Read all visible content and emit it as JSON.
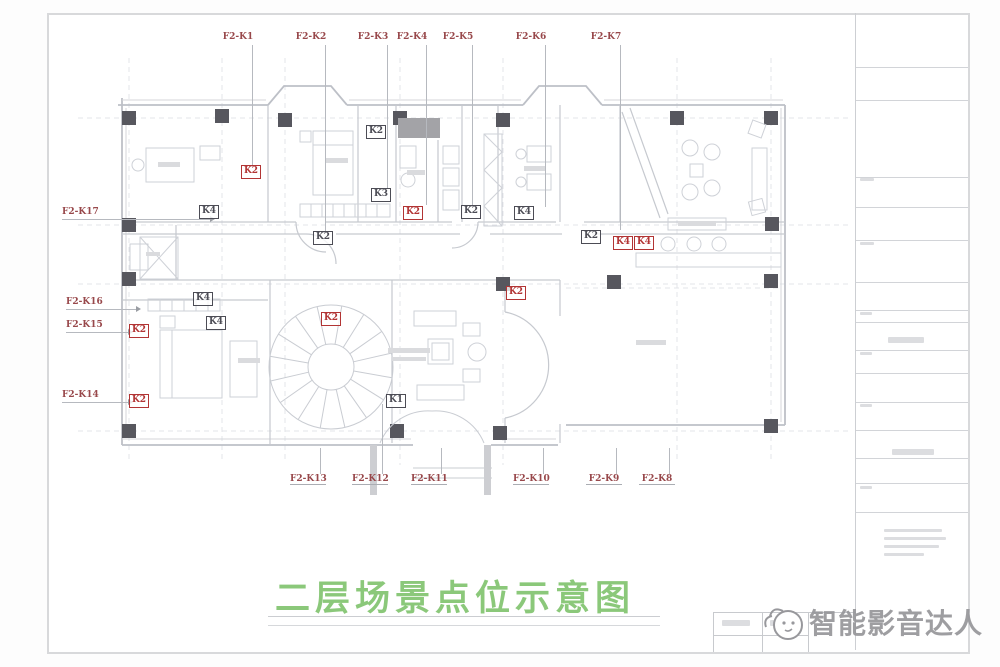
{
  "sheet": {
    "title": "二层场景点位示意图",
    "watermark": {
      "text": "智能影音达人"
    },
    "colors": {
      "title_green": "#8bc87a",
      "label_red": "#98484b",
      "marker_red": "#b23434",
      "marker_dark": "#4c4c55",
      "wall_gray": "#bdc0c7",
      "column_gray": "#57575e"
    },
    "point_labels": {
      "top": [
        {
          "text": "F2-K1",
          "x": 238,
          "line_to": 168
        },
        {
          "text": "F2-K2",
          "x": 311,
          "line_to": 232
        },
        {
          "text": "F2-K3",
          "x": 373,
          "line_to": 188
        },
        {
          "text": "F2-K4",
          "x": 412,
          "line_to": 205
        },
        {
          "text": "F2-K5",
          "x": 458,
          "line_to": 205
        },
        {
          "text": "F2-K6",
          "x": 531,
          "line_to": 207
        },
        {
          "text": "F2-K7",
          "x": 606,
          "line_to": 230
        }
      ],
      "left": [
        {
          "text": "F2-K17",
          "x": 62,
          "y": 213,
          "line_x2": 212
        },
        {
          "text": "F2-K16",
          "x": 66,
          "y": 303,
          "line_x2": 138
        },
        {
          "text": "F2-K15",
          "x": 66,
          "y": 326,
          "line_x2": 130
        },
        {
          "text": "F2-K14",
          "x": 62,
          "y": 396,
          "line_x2": 130
        }
      ],
      "bottom": [
        {
          "text": "F2-K13",
          "x": 308,
          "line_to": 448
        },
        {
          "text": "F2-K12",
          "x": 370,
          "line_to": 404
        },
        {
          "text": "F2-K11",
          "x": 429,
          "line_to": 448
        },
        {
          "text": "F2-K10",
          "x": 531,
          "line_to": 448
        },
        {
          "text": "F2-K9",
          "x": 604,
          "line_to": 448
        },
        {
          "text": "F2-K8",
          "x": 657,
          "line_to": 448
        }
      ]
    },
    "markers": [
      {
        "text": "K2",
        "x": 250,
        "y": 171,
        "color": "red"
      },
      {
        "text": "K4",
        "x": 208,
        "y": 211,
        "color": "dark"
      },
      {
        "text": "K2",
        "x": 375,
        "y": 131,
        "color": "dark"
      },
      {
        "text": "K3",
        "x": 380,
        "y": 194,
        "color": "dark"
      },
      {
        "text": "K2",
        "x": 412,
        "y": 212,
        "color": "red"
      },
      {
        "text": "K2",
        "x": 322,
        "y": 237,
        "color": "dark"
      },
      {
        "text": "K2",
        "x": 470,
        "y": 211,
        "color": "dark"
      },
      {
        "text": "K4",
        "x": 523,
        "y": 212,
        "color": "dark"
      },
      {
        "text": "K2",
        "x": 590,
        "y": 236,
        "color": "dark"
      },
      {
        "text": "K4",
        "x": 622,
        "y": 242,
        "color": "red"
      },
      {
        "text": "K4",
        "x": 643,
        "y": 242,
        "color": "red"
      },
      {
        "text": "K2",
        "x": 515,
        "y": 292,
        "color": "red"
      },
      {
        "text": "K2",
        "x": 330,
        "y": 318,
        "color": "red"
      },
      {
        "text": "K1",
        "x": 395,
        "y": 400,
        "color": "dark"
      },
      {
        "text": "K4",
        "x": 202,
        "y": 298,
        "color": "dark"
      },
      {
        "text": "K4",
        "x": 215,
        "y": 322,
        "color": "dark"
      },
      {
        "text": "K2",
        "x": 138,
        "y": 330,
        "color": "red"
      },
      {
        "text": "K2",
        "x": 138,
        "y": 400,
        "color": "red"
      }
    ]
  }
}
